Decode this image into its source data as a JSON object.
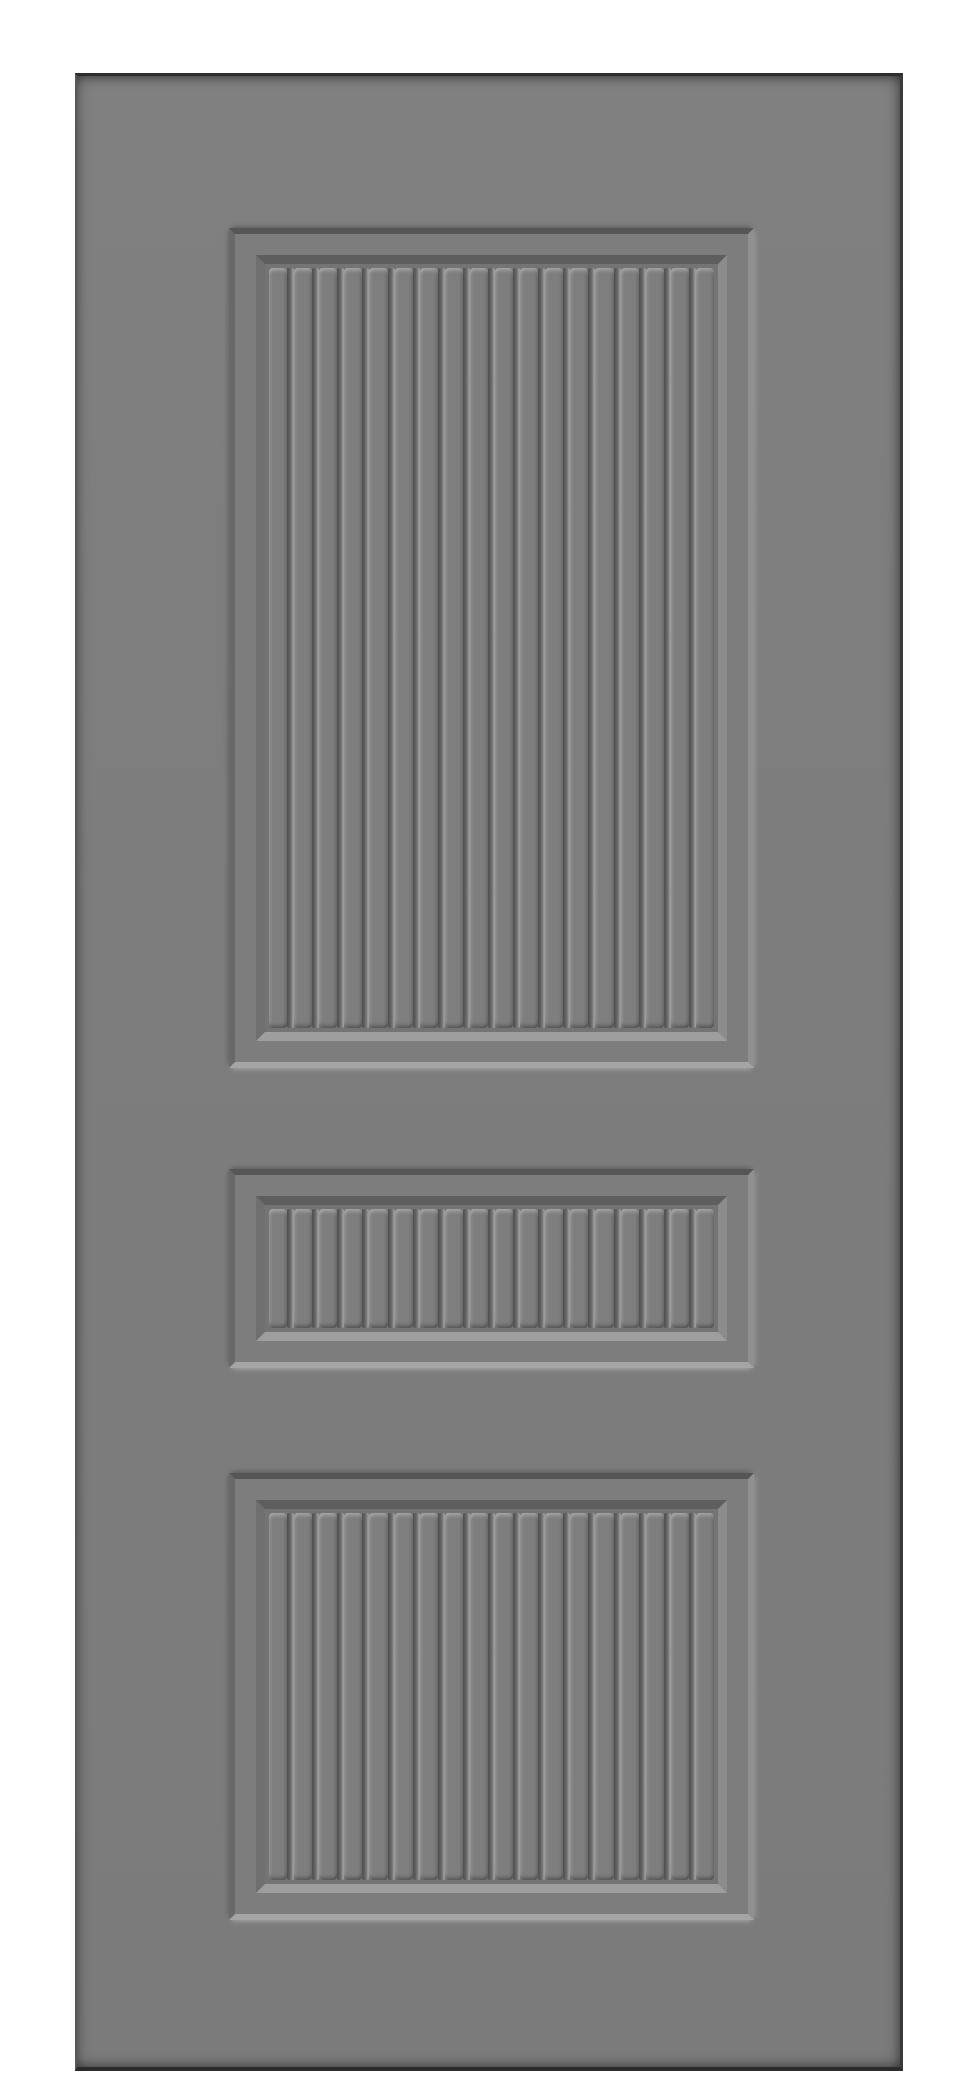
{
  "scene": {
    "description": "Front-facing product render of a plain gray interior door with three recessed vertical bead-board slat panels (large top panel, small middle panel, medium bottom panel); no handle, hinges or text; white background",
    "background_color": "#ffffff"
  },
  "door": {
    "x": 75,
    "y": 73,
    "width": 828,
    "height": 1998,
    "face_color": "#7d7d7d",
    "edge_colors": {
      "top": "#2e2e2e",
      "right": "#3a3a3a",
      "bottom": "#2b2b2b",
      "left": "#585858"
    }
  },
  "panels": [
    {
      "id": "panel-top",
      "x": 152,
      "y": 152,
      "width": 525,
      "height": 840,
      "slat_count": 18
    },
    {
      "id": "panel-middle",
      "x": 152,
      "y": 1093,
      "width": 525,
      "height": 199,
      "slat_count": 18
    },
    {
      "id": "panel-bottom",
      "x": 152,
      "y": 1397,
      "width": 525,
      "height": 447,
      "slat_count": 18
    }
  ],
  "panel_style": {
    "outer_bevel_colors": {
      "top": "#565656",
      "left": "#696969",
      "right": "#909090",
      "bottom": "#a5a5a5"
    },
    "inner_bevel_colors": {
      "top": "#5e5e5e",
      "left": "#6f6f6f",
      "right": "#8c8c8c",
      "bottom": "#9e9e9e"
    },
    "field_background": "#747474",
    "slat_face": "#7e7e7e",
    "groove_dark": "#4f4f4f",
    "groove_light": "#a2a2a2"
  }
}
